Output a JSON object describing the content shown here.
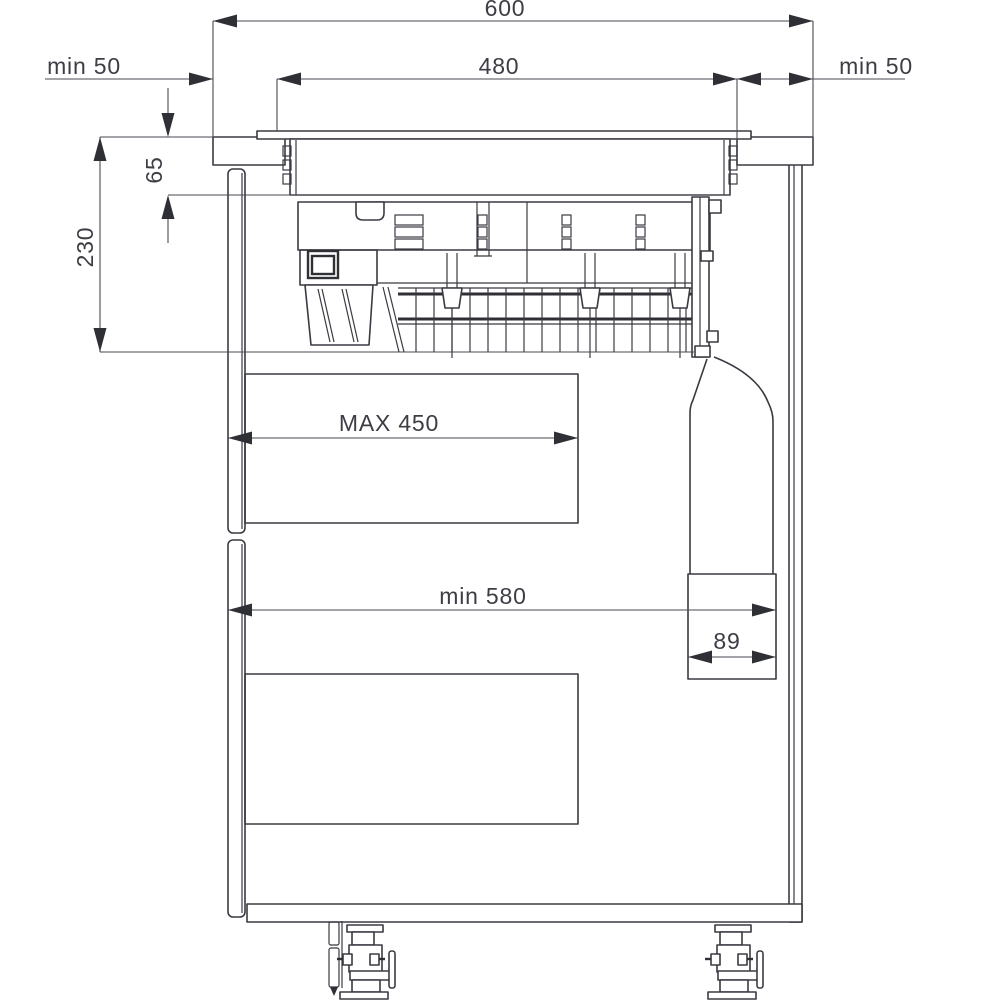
{
  "diagram": {
    "type": "installation-dimension-drawing",
    "subject": "built-in hob with downdraft extractor installed in kitchen cabinet, cross-section side view",
    "labels": {
      "total_width": "600",
      "cutout_width": "480",
      "clearance_left": "min 50",
      "clearance_right": "min 50",
      "hob_recess_depth": "65",
      "unit_depth": "230",
      "drawer_max_width": "MAX 450",
      "cabinet_min_width": "min 580",
      "duct_width": "89"
    },
    "colors": {
      "line": "#3a3a42",
      "dimension_line": "#4a4a52",
      "text": "#3d3d45",
      "background": "#ffffff"
    }
  }
}
